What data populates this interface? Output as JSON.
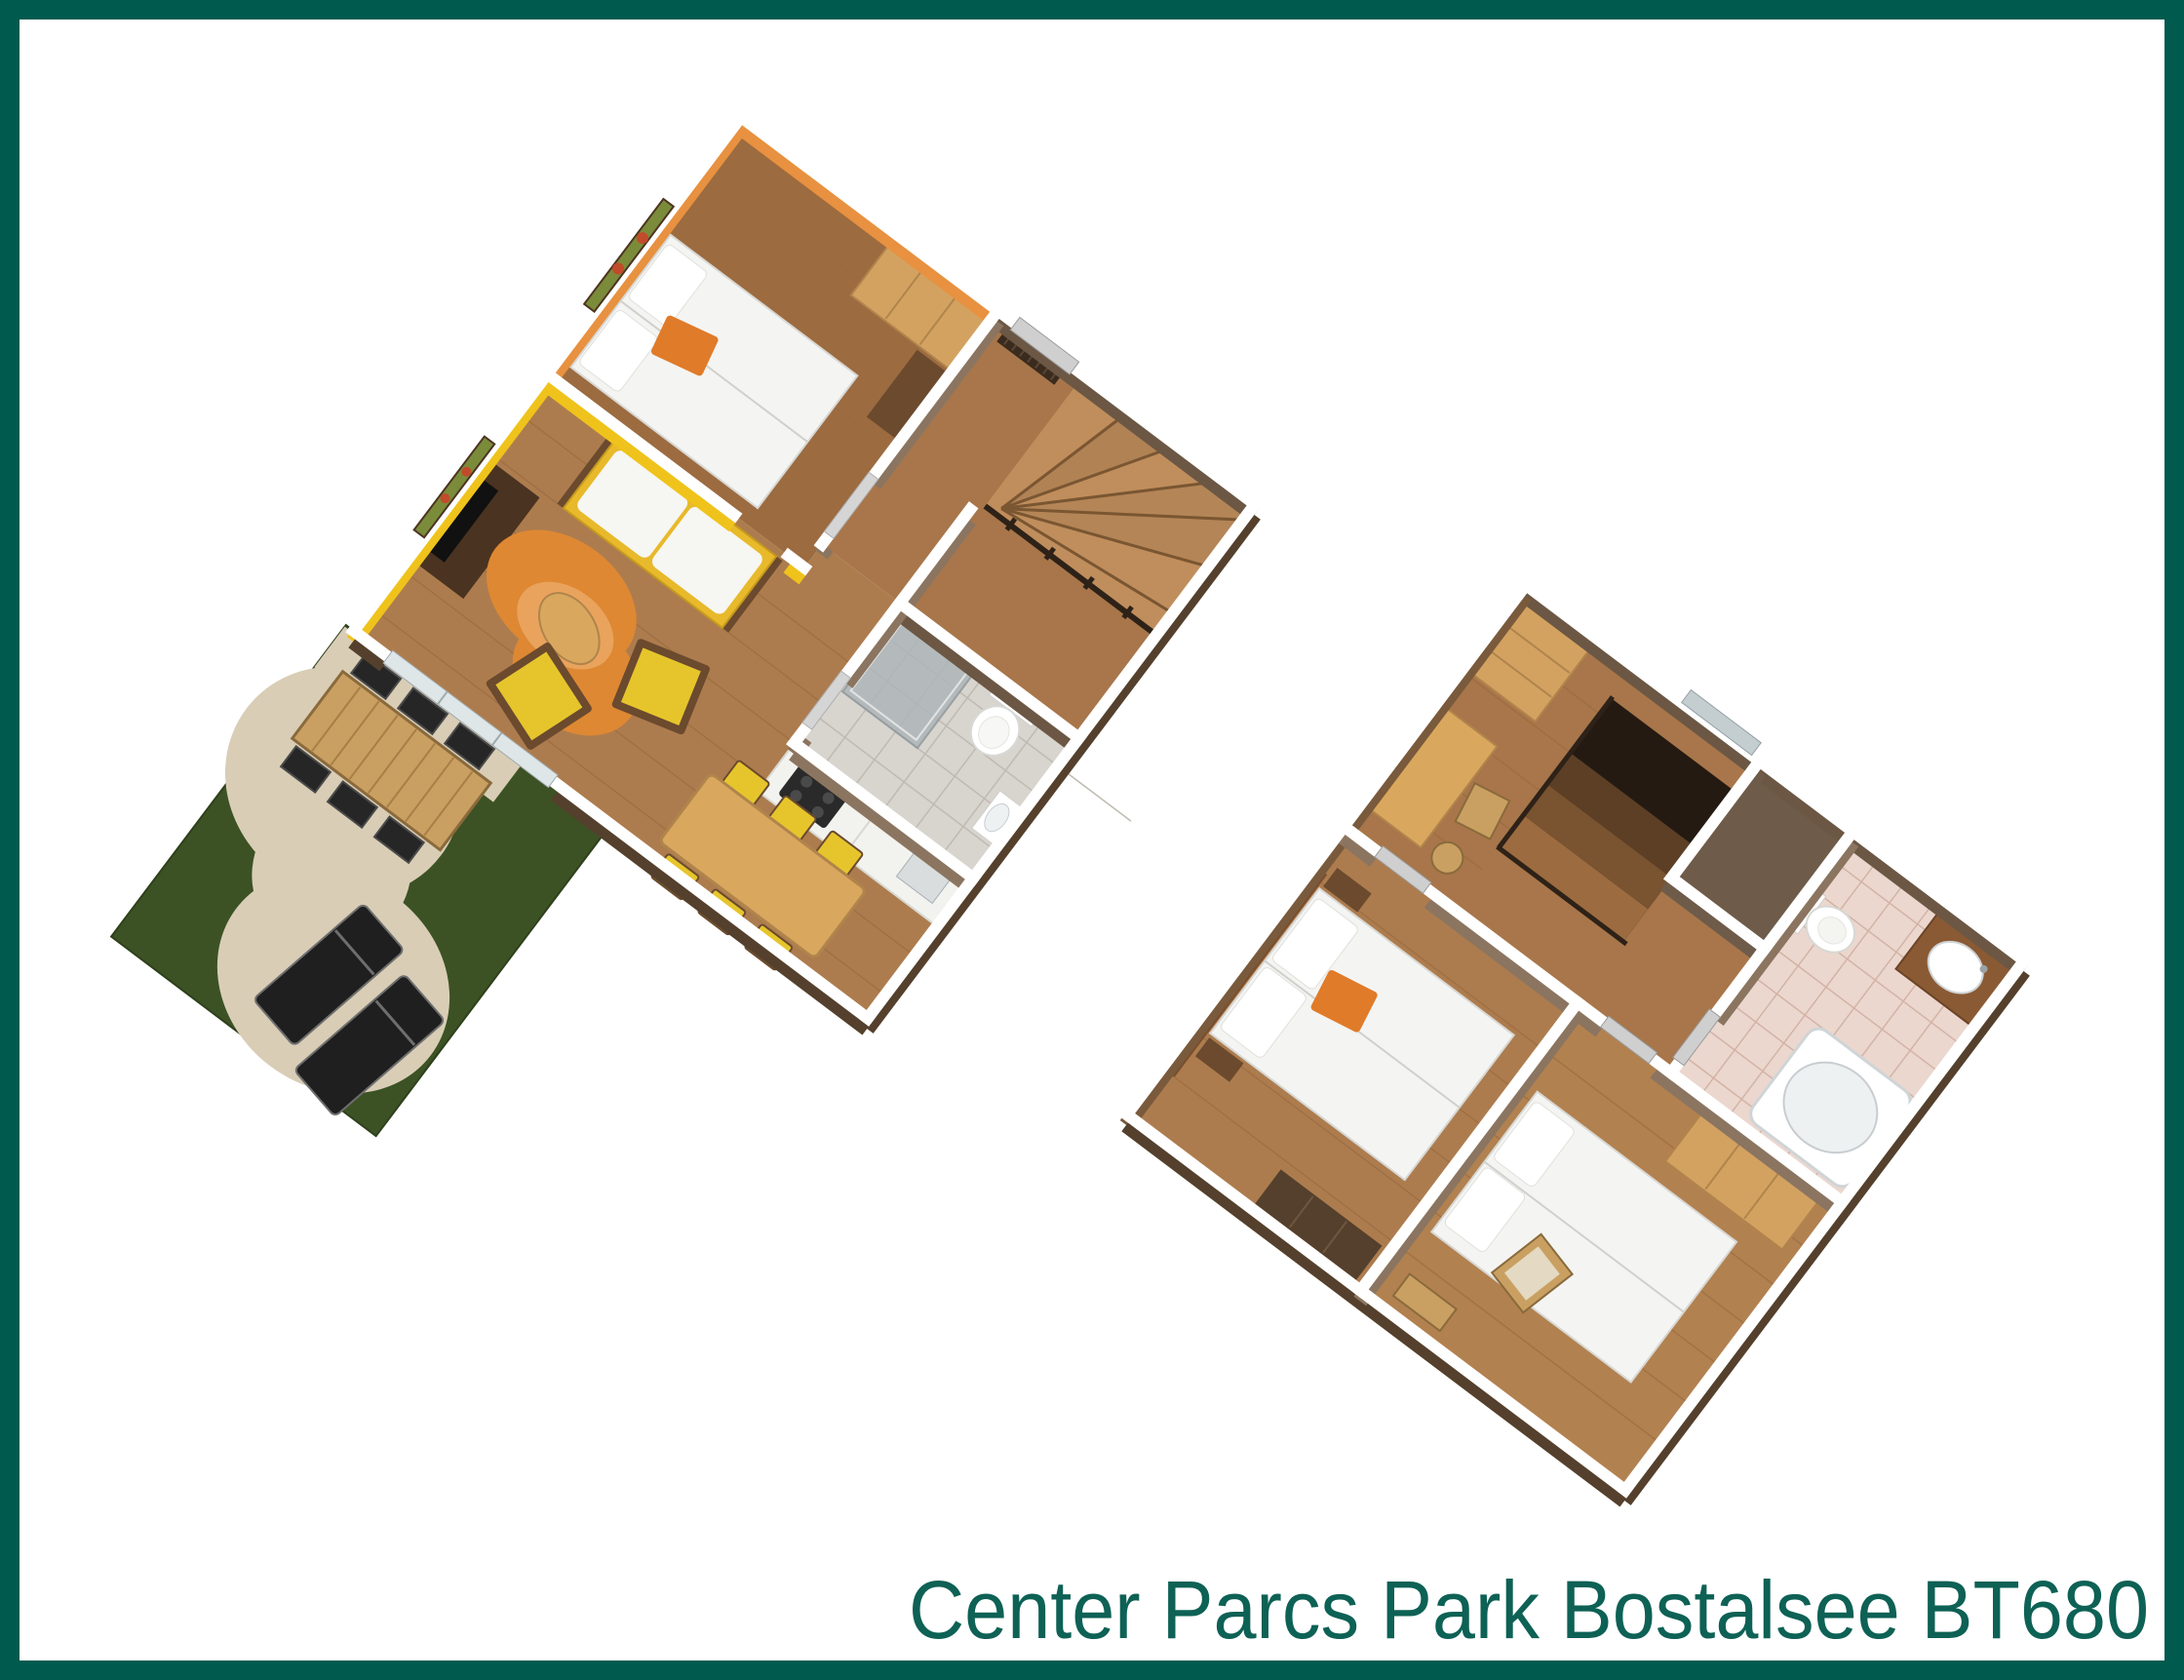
{
  "caption": {
    "text": "Center Parcs Park Bostalsee BT680"
  },
  "palette": {
    "border_teal": "#005B4E",
    "caption_teal": "#0E6155",
    "background": "#FFFFFF",
    "bedroom_orange": "#E89140",
    "living_yellow": "#EFC31B",
    "wood_floor": "#A8764A",
    "dark_wood": "#54402C",
    "light_wood": "#D9A85E",
    "grass_green": "#3C5224",
    "patio_sand": "#D9CDB6",
    "rug_orange": "#DE8833",
    "chair_yellow": "#E6C52C",
    "bath_tile_pink": "#EBD7CE",
    "bath_tile_gray": "#D8D4CE"
  }
}
